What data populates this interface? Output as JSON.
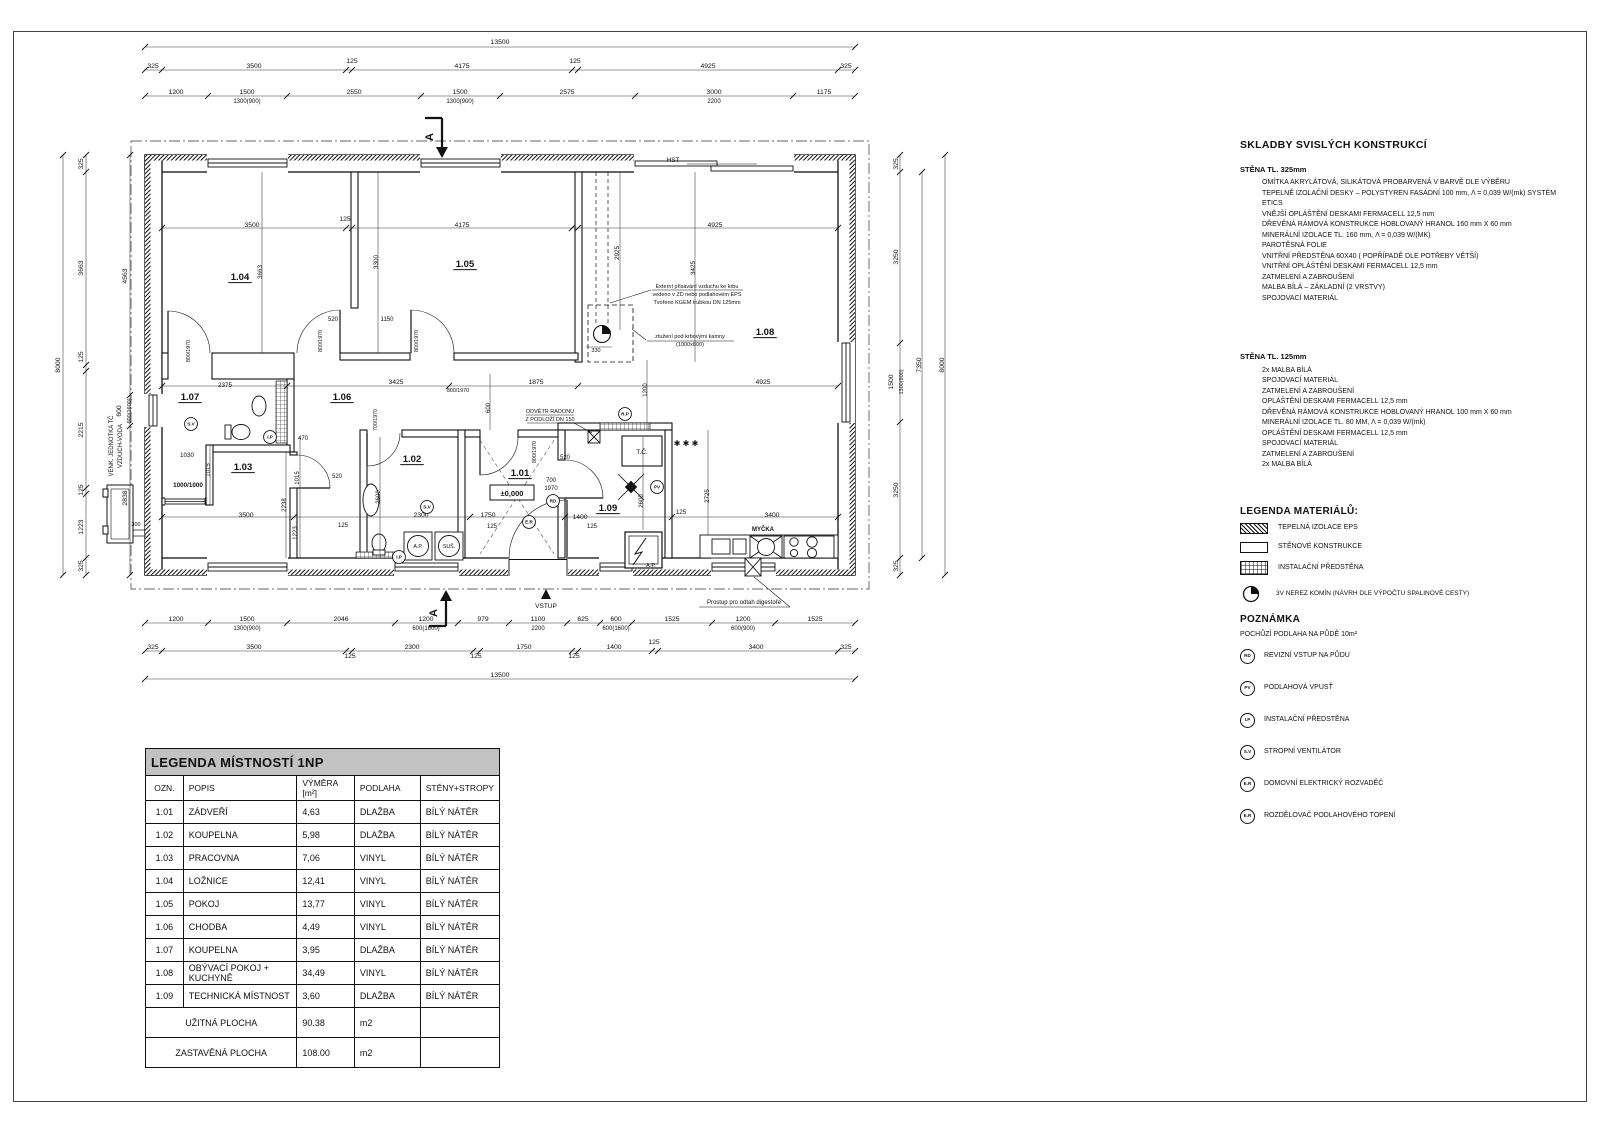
{
  "panel": {
    "skladby_title": "SKLADBY SVISLÝCH KONSTRUKCÍ",
    "wall1": {
      "title": "STĚNA TL. 325mm",
      "lines": [
        "OMÍTKA AKRYLÁTOVÁ, SILIKÁTOVÁ PROBARVENÁ V BARVĚ DLE VÝBĚRU",
        "TEPELNĚ IZOLAČNÍ DESKY – POLYSTYREN FASÁDNÍ 100 mm, Λ = 0,039 W/(mk) SYSTÉM ETICS",
        "VNĚJŠÍ OPLÁŠTĚNÍ DESKAMI FERMACELL 12,5 mm",
        "DŘEVĚNÁ RÁMOVÁ KONSTRUKCE HOBLOVANÝ HRANOL 160 mm X 60 mm",
        "MINERÁLNÍ IZOLACE TL. 160 mm, Λ = 0,039 W/(MK)",
        "PAROTĚSNÁ FOLIE",
        "VNITŘNÍ PŘEDSTĚNA 60X40 ( POPŘÍPADĚ DLE POTŘEBY VĚTŠÍ)",
        "VNITŘNÍ OPLÁŠTĚNÍ DESKAMI FERMACELL 12,5 mm",
        "ZATMELENÍ A ZABROUŠENÍ",
        "MALBA BÍLÁ – ZÁKLADNÍ (2 VRSTVY)",
        "SPOJOVACÍ MATERIÁL"
      ]
    },
    "wall2": {
      "title": "STĚNA TL. 125mm",
      "lines": [
        "2x MALBA BÍLÁ",
        "SPOJOVACÍ MATERIÁL",
        "ZATMELENÍ A ZABROUŠENÍ",
        "OPLÁŠTĚNÍ DESKAMI FERMACELL 12,5 mm",
        "DŘEVĚNÁ RÁMOVÁ KONSTRUKCE HOBLOVANÝ HRANOL 100 mm X 60 mm",
        "MINERÁLNÍ IZOLACE TL. 80 MM, Λ = 0,039 W/(mk)",
        "OPLÁŠTĚNÍ DESKAMI FERMACELL 12,5 mm",
        "SPOJOVACÍ MATERIÁL",
        "ZATMELENÍ A ZABROUŠENÍ",
        "2x MALBA BÍLÁ"
      ]
    },
    "legend_title": "LEGENDA MATERIÁLŮ:",
    "legend_items": [
      "TEPELNÁ IZOLACE EPS",
      "STĚNOVÉ KONSTRUKCE",
      "INSTALAČNÍ PŘEDSTĚNA",
      "3V NEREZ KOMÍN (NÁVRH DLE VÝPOČTU SPALINOVÉ CESTY)"
    ],
    "note_title": "POZNÁMKA",
    "note_line": "POCHŮZÍ PODLAHA NA PŮDĚ 10m²",
    "symbols": [
      {
        "code": "RD",
        "label": "REVIZNÍ VSTUP NA PŮDU"
      },
      {
        "code": "PV",
        "label": "PODLAHOVÁ VPUSŤ"
      },
      {
        "code": "I.P",
        "label": "INSTALAČNÍ PŘEDSTĚNA"
      },
      {
        "code": "S.V",
        "label": "STROPNÍ VENTILÁTOR"
      },
      {
        "code": "E.R",
        "label": "DOMOVNÍ ELEKTRICKÝ ROZVADĚČ"
      },
      {
        "code": "E.R",
        "label": "ROZDĚLOVAČ PODLAHOVÉHO TOPENÍ"
      }
    ]
  },
  "table": {
    "title": "LEGENDA MÍSTNOSTÍ 1NP",
    "headers": [
      "OZN.",
      "POPIS",
      "VÝMĚRA [m²]",
      "PODLAHA",
      "STĚNY+STROPY"
    ],
    "rows": [
      [
        "1.01",
        "ZÁDVEŘÍ",
        "4,63",
        "DLAŽBA",
        "BÍLÝ NÁTĚR"
      ],
      [
        "1.02",
        "KOUPELNA",
        "5,98",
        "DLAŽBA",
        "BÍLÝ NÁTĚR"
      ],
      [
        "1.03",
        "PRACOVNA",
        "7,06",
        "VINYL",
        "BÍLÝ NÁTĚR"
      ],
      [
        "1.04",
        "LOŽNICE",
        "12,41",
        "VINYL",
        "BÍLÝ NÁTĚR"
      ],
      [
        "1.05",
        "POKOJ",
        "13,77",
        "VINYL",
        "BÍLÝ NÁTĚR"
      ],
      [
        "1.06",
        "CHODBA",
        "4,49",
        "VINYL",
        "BÍLÝ NÁTĚR"
      ],
      [
        "1.07",
        "KOUPELNA",
        "3,95",
        "DLAŽBA",
        "BÍLÝ NÁTĚR"
      ],
      [
        "1.08",
        "OBÝVACÍ POKOJ + KUCHYNĚ",
        "34,49",
        "VINYL",
        "BÍLÝ NÁTĚR"
      ],
      [
        "1.09",
        "TECHNICKÁ MÍSTNOST",
        "3,60",
        "DLAŽBA",
        "BÍLÝ NÁTĚR"
      ]
    ],
    "footer_rows": [
      [
        "UŽITNÁ PLOCHA",
        "90.38",
        "m2",
        ""
      ],
      [
        "ZASTAVĚNÁ PLOCHA",
        "108.00",
        "m2",
        ""
      ]
    ]
  },
  "plan_labels": [
    {
      "t": "13500",
      "x": 500,
      "y": 44
    },
    {
      "t": "325",
      "x": 153,
      "y": 68
    },
    {
      "t": "3500",
      "x": 254,
      "y": 68
    },
    {
      "t": "125",
      "x": 352,
      "y": 63
    },
    {
      "t": "4175",
      "x": 462,
      "y": 68
    },
    {
      "t": "125",
      "x": 575,
      "y": 63
    },
    {
      "t": "4925",
      "x": 708,
      "y": 68
    },
    {
      "t": "325",
      "x": 846,
      "y": 68
    },
    {
      "t": "1200",
      "x": 176,
      "y": 94
    },
    {
      "t": "1500",
      "x": 247,
      "y": 94
    },
    {
      "t": "2550",
      "x": 354,
      "y": 94
    },
    {
      "t": "1500",
      "x": 460,
      "y": 94
    },
    {
      "t": "2575",
      "x": 567,
      "y": 94
    },
    {
      "t": "3000",
      "x": 714,
      "y": 94
    },
    {
      "t": "1175",
      "x": 824,
      "y": 94
    },
    {
      "t": "1300(900)",
      "x": 247,
      "y": 103,
      "s": 6
    },
    {
      "t": "1300(900)",
      "x": 460,
      "y": 103,
      "s": 6
    },
    {
      "t": "2200",
      "x": 714,
      "y": 103,
      "s": 6
    },
    {
      "t": "1200",
      "x": 176,
      "y": 621
    },
    {
      "t": "1500",
      "x": 247,
      "y": 621
    },
    {
      "t": "2046",
      "x": 341,
      "y": 621
    },
    {
      "t": "1200",
      "x": 426,
      "y": 621
    },
    {
      "t": "979",
      "x": 483,
      "y": 621
    },
    {
      "t": "1100",
      "x": 538,
      "y": 621
    },
    {
      "t": "625",
      "x": 583,
      "y": 621
    },
    {
      "t": "600",
      "x": 616,
      "y": 621
    },
    {
      "t": "1525",
      "x": 672,
      "y": 621
    },
    {
      "t": "1200",
      "x": 743,
      "y": 621
    },
    {
      "t": "1525",
      "x": 815,
      "y": 621
    },
    {
      "t": "1300(900)",
      "x": 247,
      "y": 630,
      "s": 6
    },
    {
      "t": "600(1600)",
      "x": 426,
      "y": 630,
      "s": 6
    },
    {
      "t": "2200",
      "x": 538,
      "y": 630,
      "s": 6
    },
    {
      "t": "600(1600)",
      "x": 616,
      "y": 630,
      "s": 6
    },
    {
      "t": "600(900)",
      "x": 743,
      "y": 630,
      "s": 6
    },
    {
      "t": "325",
      "x": 153,
      "y": 649
    },
    {
      "t": "3500",
      "x": 254,
      "y": 649
    },
    {
      "t": "125",
      "x": 350,
      "y": 658
    },
    {
      "t": "2300",
      "x": 412,
      "y": 649
    },
    {
      "t": "125",
      "x": 476,
      "y": 658
    },
    {
      "t": "1750",
      "x": 524,
      "y": 649
    },
    {
      "t": "125",
      "x": 574,
      "y": 658
    },
    {
      "t": "1400",
      "x": 614,
      "y": 649
    },
    {
      "t": "125",
      "x": 654,
      "y": 644
    },
    {
      "t": "3400",
      "x": 756,
      "y": 649
    },
    {
      "t": "325",
      "x": 846,
      "y": 649
    },
    {
      "t": "13500",
      "x": 500,
      "y": 677
    },
    {
      "t": "8000",
      "x": 60,
      "y": 365,
      "r": 1
    },
    {
      "t": "325",
      "x": 83,
      "y": 164,
      "r": 1
    },
    {
      "t": "3663",
      "x": 83,
      "y": 268,
      "r": 1
    },
    {
      "t": "125",
      "x": 83,
      "y": 357,
      "r": 1
    },
    {
      "t": "2215",
      "x": 83,
      "y": 430,
      "r": 1
    },
    {
      "t": "125",
      "x": 83,
      "y": 490,
      "r": 1
    },
    {
      "t": "1223",
      "x": 83,
      "y": 527,
      "r": 1
    },
    {
      "t": "325",
      "x": 83,
      "y": 566,
      "r": 1
    },
    {
      "t": "4563",
      "x": 127,
      "y": 276,
      "r": 1
    },
    {
      "t": "600",
      "x": 121,
      "y": 411,
      "r": 1
    },
    {
      "t": "600(1600)",
      "x": 131,
      "y": 411,
      "r": 1,
      "s": 5.5
    },
    {
      "t": "2838",
      "x": 127,
      "y": 498,
      "r": 1
    },
    {
      "t": "VENK. JEDNOTKA TČ",
      "x": 113,
      "y": 446,
      "r": 1,
      "s": 6
    },
    {
      "t": "VZDUCH-VODA",
      "x": 122,
      "y": 446,
      "r": 1,
      "s": 6
    },
    {
      "t": "300",
      "x": 136,
      "y": 526,
      "s": 5.5
    },
    {
      "t": "325",
      "x": 898,
      "y": 164,
      "r": 1
    },
    {
      "t": "3250",
      "x": 898,
      "y": 257,
      "r": 1
    },
    {
      "t": "1500",
      "x": 893,
      "y": 382,
      "r": 1
    },
    {
      "t": "1300(900)",
      "x": 903,
      "y": 382,
      "r": 1,
      "s": 5.5
    },
    {
      "t": "3250",
      "x": 898,
      "y": 490,
      "r": 1
    },
    {
      "t": "325",
      "x": 898,
      "y": 566,
      "r": 1
    },
    {
      "t": "7350",
      "x": 921,
      "y": 365,
      "r": 1
    },
    {
      "t": "8000",
      "x": 944,
      "y": 365,
      "r": 1
    },
    {
      "t": "1.04",
      "x": 240,
      "y": 280,
      "b": 1,
      "u": 1,
      "s": 9.5
    },
    {
      "t": "1.05",
      "x": 465,
      "y": 267,
      "b": 1,
      "u": 1,
      "s": 9.5
    },
    {
      "t": "1.08",
      "x": 765,
      "y": 335,
      "b": 1,
      "u": 1,
      "s": 9.5
    },
    {
      "t": "1.07",
      "x": 190,
      "y": 400,
      "b": 1,
      "u": 1,
      "s": 9.5
    },
    {
      "t": "1.03",
      "x": 243,
      "y": 470,
      "b": 1,
      "u": 1,
      "s": 9.5
    },
    {
      "t": "1.06",
      "x": 342,
      "y": 400,
      "b": 1,
      "u": 1,
      "s": 9.5
    },
    {
      "t": "1.02",
      "x": 412,
      "y": 462,
      "b": 1,
      "u": 1,
      "s": 9.5
    },
    {
      "t": "1.01",
      "x": 520,
      "y": 476,
      "b": 1,
      "u": 1,
      "s": 9.5
    },
    {
      "t": "1.09",
      "x": 608,
      "y": 511,
      "b": 1,
      "u": 1,
      "s": 9.5
    },
    {
      "t": "3500",
      "x": 252,
      "y": 227
    },
    {
      "t": "125",
      "x": 345,
      "y": 221
    },
    {
      "t": "4175",
      "x": 462,
      "y": 227
    },
    {
      "t": "4925",
      "x": 715,
      "y": 227
    },
    {
      "t": "3663",
      "x": 262,
      "y": 272,
      "r": 1,
      "s": 6.3
    },
    {
      "t": "3300",
      "x": 378,
      "y": 262,
      "r": 1,
      "s": 6.3
    },
    {
      "t": "2925",
      "x": 619,
      "y": 253,
      "r": 1,
      "s": 6.3
    },
    {
      "t": "3425",
      "x": 695,
      "y": 268,
      "r": 1,
      "s": 6.3
    },
    {
      "t": "1200",
      "x": 647,
      "y": 390,
      "r": 1,
      "s": 6
    },
    {
      "t": "2725",
      "x": 709,
      "y": 496,
      "r": 1,
      "s": 6
    },
    {
      "t": "2600",
      "x": 643,
      "y": 501,
      "r": 1,
      "s": 6
    },
    {
      "t": "2600",
      "x": 380,
      "y": 497,
      "r": 1,
      "s": 6
    },
    {
      "t": "2238",
      "x": 286,
      "y": 505,
      "r": 1,
      "s": 6
    },
    {
      "t": "1223",
      "x": 297,
      "y": 533,
      "r": 1,
      "s": 6
    },
    {
      "t": "1015",
      "x": 299,
      "y": 478,
      "r": 1,
      "s": 6
    },
    {
      "t": "1015",
      "x": 210,
      "y": 470,
      "r": 1,
      "s": 6
    },
    {
      "t": "2375",
      "x": 225,
      "y": 387,
      "s": 6.3
    },
    {
      "t": "3425",
      "x": 396,
      "y": 384
    },
    {
      "t": "1875",
      "x": 536,
      "y": 384
    },
    {
      "t": "4925",
      "x": 763,
      "y": 384
    },
    {
      "t": "520",
      "x": 333,
      "y": 321,
      "s": 6
    },
    {
      "t": "1150",
      "x": 387,
      "y": 321,
      "s": 6
    },
    {
      "t": "800/1970",
      "x": 322,
      "y": 341,
      "r": 1,
      "s": 5.3
    },
    {
      "t": "800/1970",
      "x": 418,
      "y": 341,
      "r": 1,
      "s": 5.3
    },
    {
      "t": "800/1970",
      "x": 190,
      "y": 351,
      "r": 1,
      "s": 5.3
    },
    {
      "t": "800/1970",
      "x": 458,
      "y": 392,
      "s": 5.3
    },
    {
      "t": "700/1970",
      "x": 377,
      "y": 420,
      "r": 1,
      "s": 5.3
    },
    {
      "t": "800/1970",
      "x": 536,
      "y": 452,
      "r": 1,
      "s": 5.3
    },
    {
      "t": "600",
      "x": 490,
      "y": 408,
      "r": 1,
      "s": 6
    },
    {
      "t": "520",
      "x": 565,
      "y": 459,
      "s": 6
    },
    {
      "t": "470",
      "x": 303,
      "y": 440,
      "s": 6
    },
    {
      "t": "520",
      "x": 337,
      "y": 478,
      "s": 6
    },
    {
      "t": "700",
      "x": 551,
      "y": 482,
      "s": 6
    },
    {
      "t": "1970",
      "x": 551,
      "y": 490,
      "s": 6
    },
    {
      "t": "1750",
      "x": 488,
      "y": 517
    },
    {
      "t": "1400",
      "x": 580,
      "y": 519
    },
    {
      "t": "125",
      "x": 492,
      "y": 528,
      "s": 6
    },
    {
      "t": "125",
      "x": 592,
      "y": 528,
      "s": 6
    },
    {
      "t": "125",
      "x": 343,
      "y": 527,
      "s": 6
    },
    {
      "t": "3500",
      "x": 246,
      "y": 517
    },
    {
      "t": "1030",
      "x": 187,
      "y": 457,
      "s": 6.3
    },
    {
      "t": "1000/1000",
      "x": 188,
      "y": 487,
      "s": 6.3,
      "b": 1
    },
    {
      "t": "2300",
      "x": 421,
      "y": 517
    },
    {
      "t": "330",
      "x": 596,
      "y": 352,
      "s": 5.5
    },
    {
      "t": "125",
      "x": 681,
      "y": 514,
      "s": 6.3
    },
    {
      "t": "3400",
      "x": 772,
      "y": 517
    },
    {
      "t": "MYČKA",
      "x": 763,
      "y": 531,
      "s": 6,
      "b": 1
    },
    {
      "t": "✱ ✱ ✱",
      "x": 686,
      "y": 446,
      "s": 8,
      "b": 1
    },
    {
      "t": "±0,000",
      "x": 512,
      "y": 496,
      "s": 7.5,
      "b": 1
    },
    {
      "t": "T.Č.",
      "x": 642,
      "y": 454,
      "s": 6.5
    },
    {
      "t": "A.P.",
      "x": 651,
      "y": 567,
      "s": 5.5
    },
    {
      "t": "A.P.",
      "x": 418,
      "y": 548,
      "s": 5.3
    },
    {
      "t": "SUŠ.",
      "x": 449,
      "y": 548,
      "s": 5.3
    },
    {
      "t": "HST",
      "x": 673,
      "y": 162,
      "s": 6.3
    },
    {
      "t": "VSTUP",
      "x": 546,
      "y": 608,
      "s": 6.5,
      "col": "#8a8a8a"
    },
    {
      "t": "Prostup pro odtah digestoře",
      "x": 744,
      "y": 604,
      "s": 6
    },
    {
      "t": "Externí přisávání vzduchu ke krbu",
      "x": 697,
      "y": 288,
      "s": 5.5
    },
    {
      "t": "vedeno v ZD nebo podlahovém EPS",
      "x": 697,
      "y": 296,
      "s": 5.5
    },
    {
      "t": "Tvořeno  KGEM trubkou DN 125mm",
      "x": 697,
      "y": 304,
      "s": 5.5
    },
    {
      "t": "ztužení pod krbovými kamny",
      "x": 690,
      "y": 338,
      "s": 5.5
    },
    {
      "t": "(1000x800)",
      "x": 690,
      "y": 346,
      "s": 5.5
    },
    {
      "t": "ODVĚTR RADONU",
      "x": 550,
      "y": 413,
      "s": 5.5
    },
    {
      "t": "Z PODLOŽÍ DN 150",
      "x": 550,
      "y": 421,
      "s": 5.5
    },
    {
      "t": "RD",
      "x": 553,
      "y": 501,
      "c": 1
    },
    {
      "t": "PV",
      "x": 657,
      "y": 487,
      "c": 1
    },
    {
      "t": "I.P",
      "x": 270,
      "y": 437,
      "c": 1
    },
    {
      "t": "I.P",
      "x": 399,
      "y": 557,
      "c": 1
    },
    {
      "t": "S.V",
      "x": 191,
      "y": 424,
      "c": 1
    },
    {
      "t": "S.V",
      "x": 427,
      "y": 507,
      "c": 1
    },
    {
      "t": "E.R",
      "x": 529,
      "y": 522,
      "c": 1
    },
    {
      "t": "R.P",
      "x": 625,
      "y": 414,
      "c": 1
    },
    {
      "t": "A",
      "x": 433,
      "y": 137,
      "r": 1,
      "s": 11,
      "b": 1
    },
    {
      "t": "A",
      "x": 437,
      "y": 613,
      "r": 1,
      "s": 11,
      "b": 1
    }
  ]
}
